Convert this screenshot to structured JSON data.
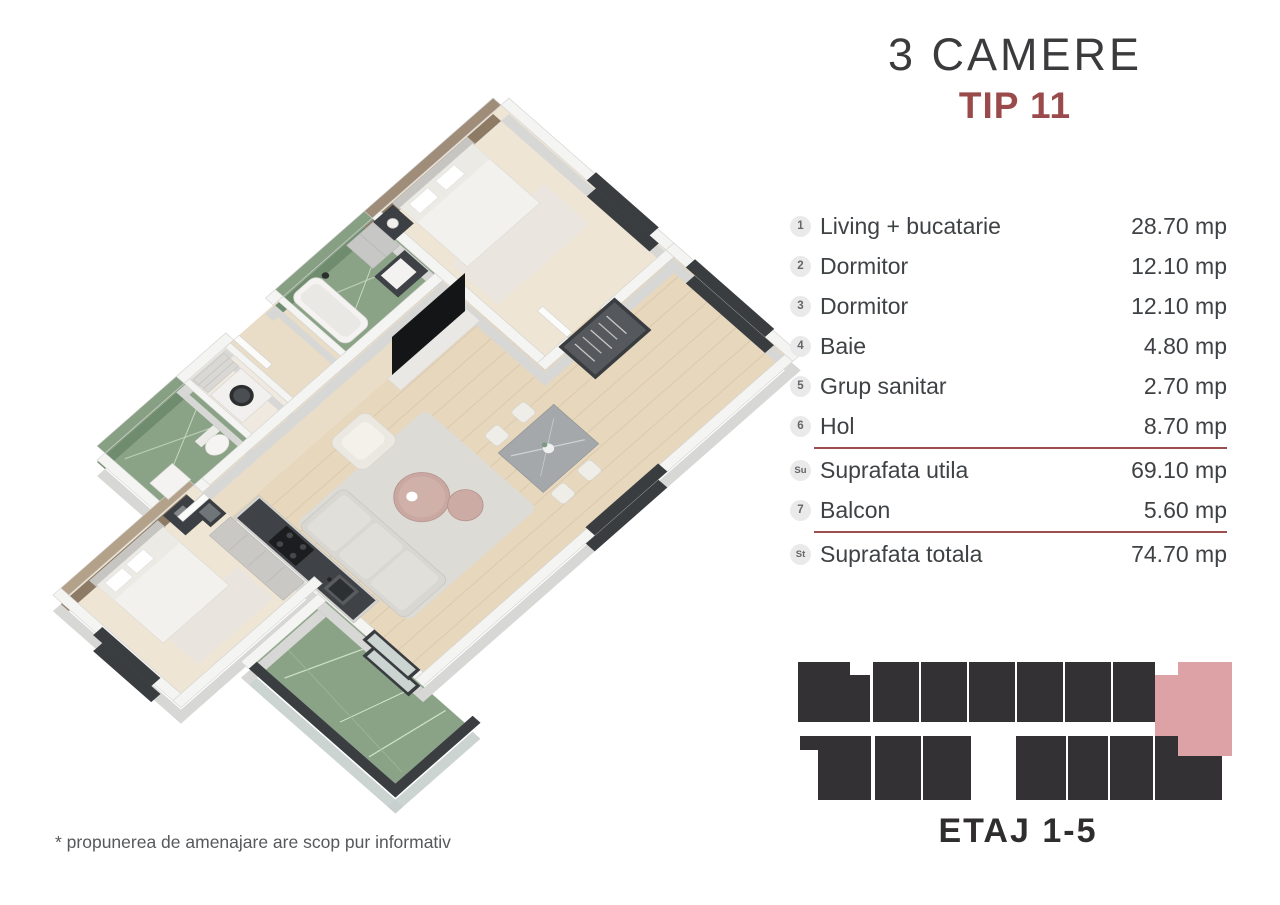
{
  "title": {
    "heading": "3 CAMERE",
    "subheading": "TIP 11"
  },
  "legend": {
    "rows": [
      {
        "badge": "1",
        "label": "Living + bucatarie",
        "value": "28.70 mp"
      },
      {
        "badge": "2",
        "label": "Dormitor",
        "value": "12.10 mp"
      },
      {
        "badge": "3",
        "label": "Dormitor",
        "value": "12.10 mp"
      },
      {
        "badge": "4",
        "label": "Baie",
        "value": "4.80 mp"
      },
      {
        "badge": "5",
        "label": "Grup sanitar",
        "value": "2.70 mp"
      },
      {
        "badge": "6",
        "label": "Hol",
        "value": "8.70 mp"
      },
      {
        "badge": "Su",
        "label": "Suprafata utila",
        "value": "69.10 mp"
      },
      {
        "badge": "7",
        "label": "Balcon",
        "value": "5.60 mp"
      },
      {
        "badge": "St",
        "label": "Suprafata totala",
        "value": "74.70 mp"
      }
    ]
  },
  "footprint": {
    "label": "ETAJ 1-5",
    "top_row_units": 8,
    "bottom_row_units": 7,
    "highlighted_unit": "top-row-rightmost",
    "units_color": "#333134",
    "highlight_color": "#dca2a5"
  },
  "disclaimer": "* propunerea de amenajare are scop pur informativ",
  "floorplan_rooms": [
    "Living + bucatarie",
    "Dormitor",
    "Dormitor",
    "Baie",
    "Grup sanitar",
    "Hol",
    "Balcon"
  ],
  "colors": {
    "accent_red": "#9a4a4a",
    "divider_red": "#9c4f4f",
    "text_dark": "#3f4245",
    "badge_bg": "#eaeaea",
    "marble_green": "#8aa386",
    "floor_wood": "#e7d7bd",
    "wall_white": "#f4f4f2",
    "dark_frame": "#3a3d40"
  }
}
